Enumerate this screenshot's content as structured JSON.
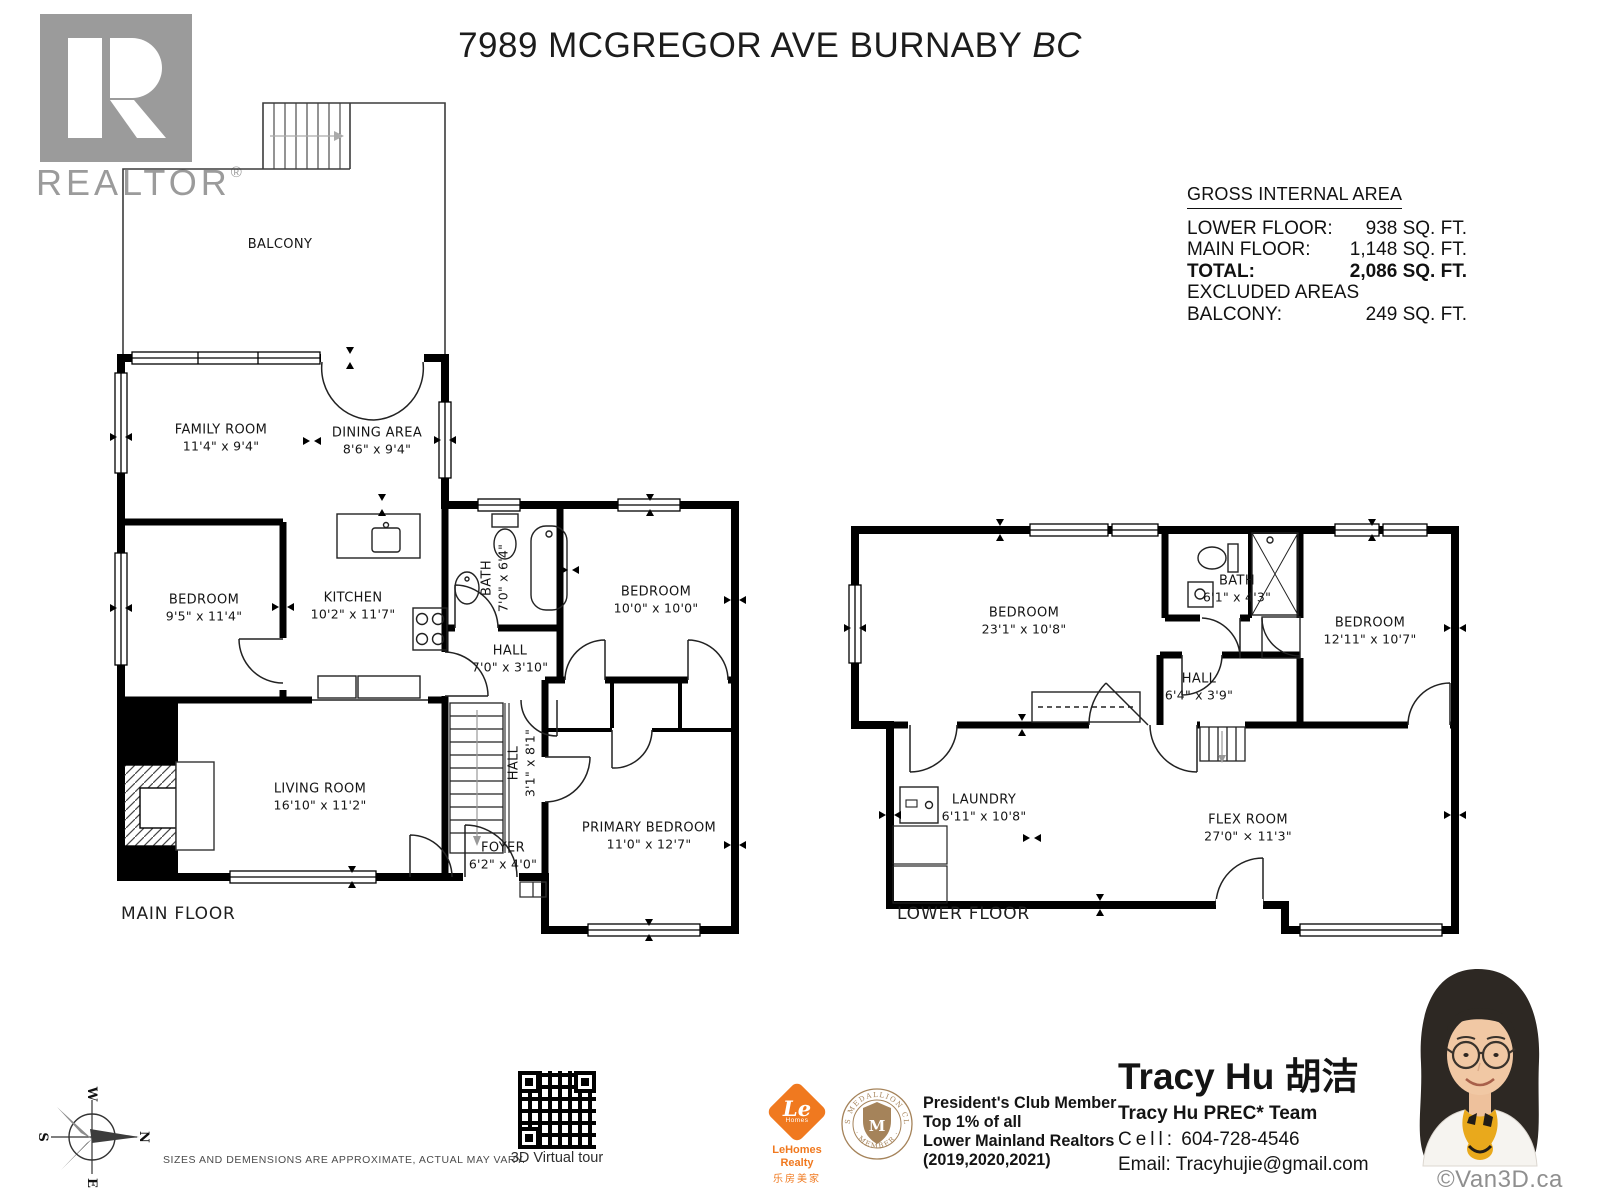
{
  "title": {
    "main": "7989 MCGREGOR AVE BURNABY",
    "suffix": "BC"
  },
  "realtor_logo": {
    "letter": "R",
    "wordmark": "REALTOR",
    "registered": "®"
  },
  "area_summary": {
    "heading": "GROSS INTERNAL AREA",
    "rows": [
      {
        "label": "LOWER FLOOR:",
        "value": "938 SQ. FT."
      },
      {
        "label": "MAIN FLOOR:",
        "value": "1,148 SQ. FT."
      },
      {
        "label": "TOTAL:",
        "value": "2,086 SQ. FT."
      },
      {
        "label": "EXCLUDED AREAS",
        "value": ""
      },
      {
        "label": "BALCONY:",
        "value": "249 SQ. FT."
      }
    ]
  },
  "main_floor": {
    "floor_label": "MAIN FLOOR",
    "rooms": {
      "balcony": {
        "name": "BALCONY",
        "dims": ""
      },
      "family_room": {
        "name": "FAMILY ROOM",
        "dims": "11'4\" x 9'4\""
      },
      "dining_area": {
        "name": "DINING AREA",
        "dims": "8'6\" x 9'4\""
      },
      "bedroom_1": {
        "name": "BEDROOM",
        "dims": "9'5\" x 11'4\""
      },
      "kitchen": {
        "name": "KITCHEN",
        "dims": "10'2\" x 11'7\""
      },
      "bath": {
        "name": "BATH",
        "dims": "7'0\" x 6'4\""
      },
      "bedroom_2": {
        "name": "BEDROOM",
        "dims": "10'0\" x 10'0\""
      },
      "hall_upper": {
        "name": "HALL",
        "dims": "7'0\" x 3'10\""
      },
      "hall_lower": {
        "name": "HALL",
        "dims": "3'1\" x 8'1\""
      },
      "living_room": {
        "name": "LIVING ROOM",
        "dims": "16'10\" x 11'2\""
      },
      "foyer": {
        "name": "FOYER",
        "dims": "6'2\" x 4'0\""
      },
      "primary_bedroom": {
        "name": "PRIMARY BEDROOM",
        "dims": "11'0\" x 12'7\""
      }
    }
  },
  "lower_floor": {
    "floor_label": "LOWER FLOOR",
    "rooms": {
      "bedroom_1": {
        "name": "BEDROOM",
        "dims": "23'1\" x 10'8\""
      },
      "bath": {
        "name": "BATH",
        "dims": "6'1\" x 4'3\""
      },
      "hall": {
        "name": "HALL",
        "dims": "6'4\" x 3'9\""
      },
      "bedroom_2": {
        "name": "BEDROOM",
        "dims": "12'11\" x 10'7\""
      },
      "laundry": {
        "name": "LAUNDRY",
        "dims": "6'11\" x 10'8\""
      },
      "flex_room": {
        "name": "FLEX ROOM",
        "dims": "27'0\" × 11'3\""
      }
    }
  },
  "footer": {
    "compass": {
      "n": "N",
      "s": "S",
      "e": "E",
      "w": "W"
    },
    "disclaimer": "SIZES AND DEMENSIONS ARE APPROXIMATE, ACTUAL MAY VARY.",
    "qr_label": "3D Virtual tour",
    "lehomes": {
      "symbol_main": "Le",
      "symbol_sub": "Homes",
      "name": "LeHomes Realty",
      "chinese": "乐房美家"
    },
    "medallion": {
      "ring_top": "MLS MEDALLION CLUB",
      "ring_bottom": "· MEMBER ·",
      "initial": "M"
    },
    "awards": [
      "President's Club Member",
      "Top 1% of all",
      "Lower Mainland Realtors",
      "(2019,2020,2021)"
    ],
    "agent": {
      "name": "Tracy Hu 胡洁",
      "team": "Tracy Hu PREC* Team",
      "cell_label": "Cell:",
      "cell_number": "604-728-4546",
      "email_label": "Email:",
      "email": "Tracyhujie@gmail.com"
    },
    "watermark": "©Van3D.ca"
  }
}
